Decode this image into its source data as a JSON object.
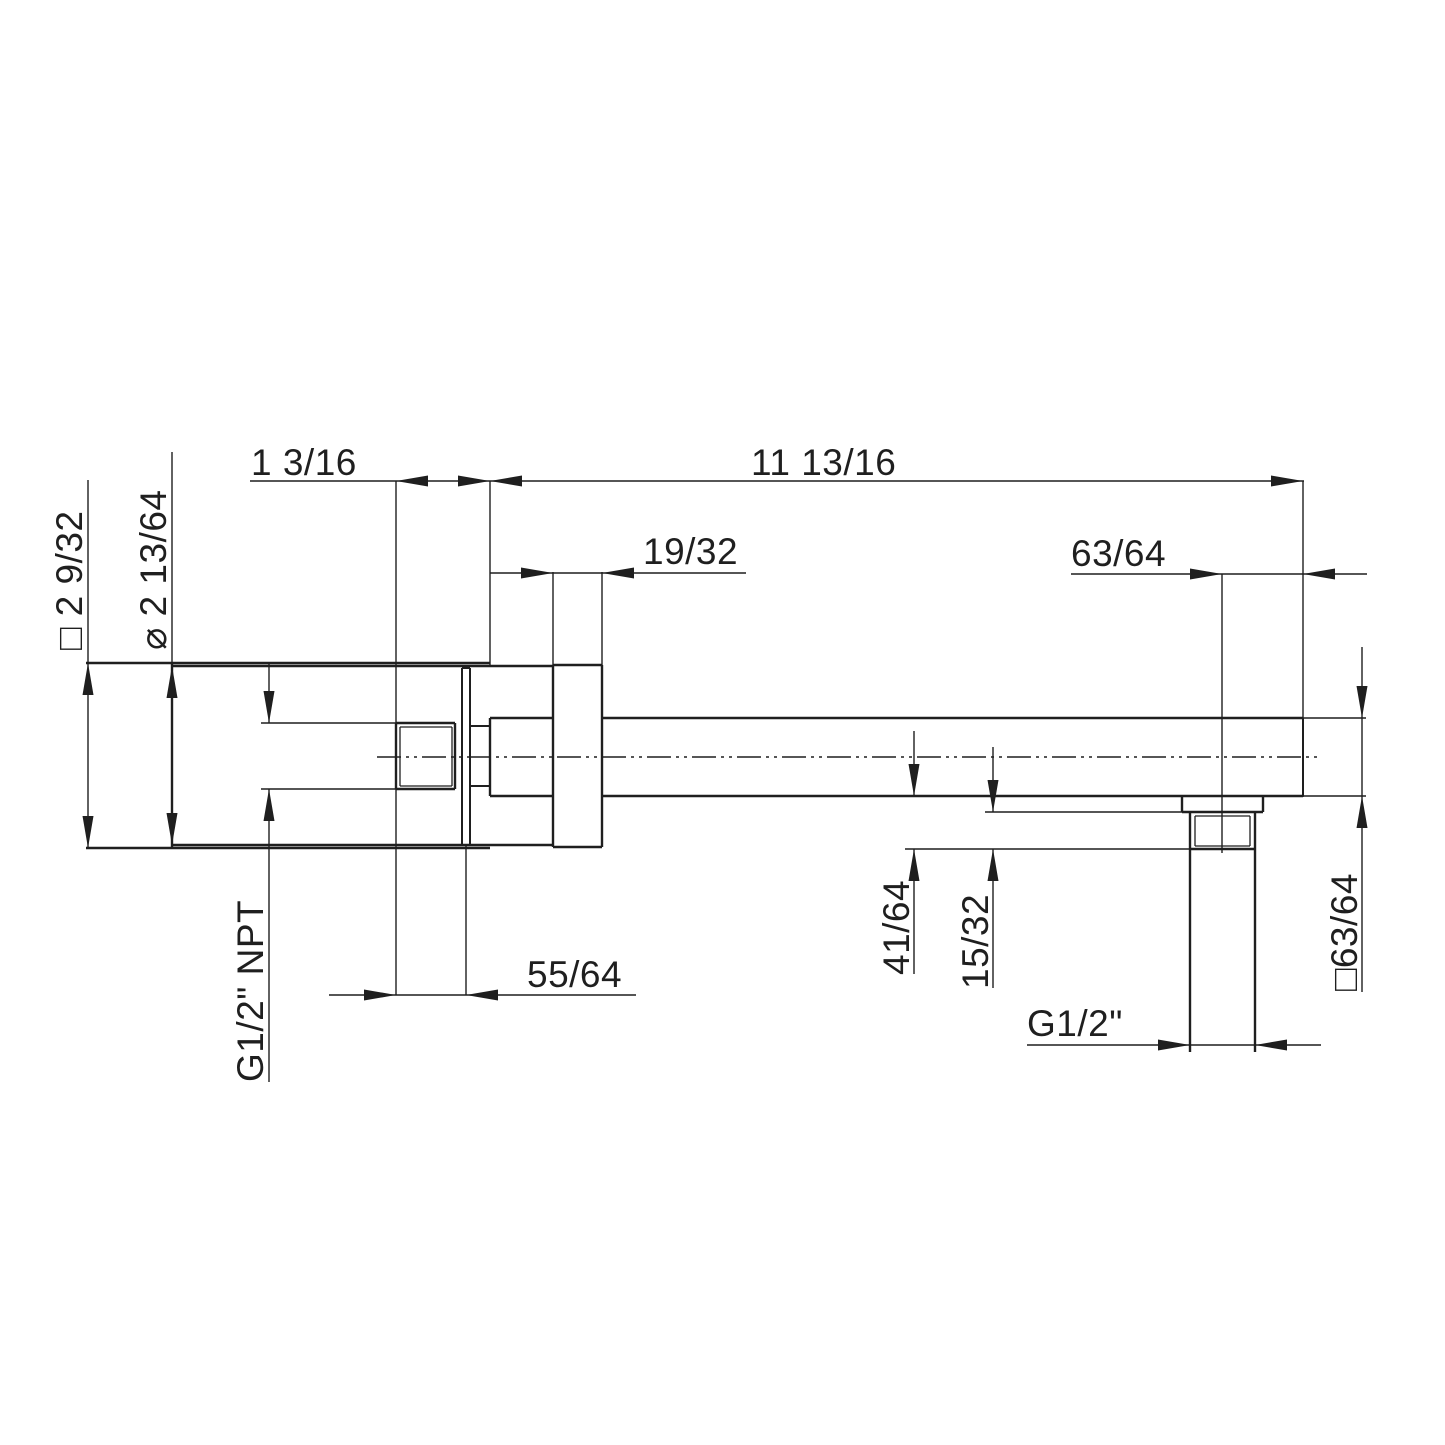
{
  "meta": {
    "background": "#ffffff",
    "line_color": "#1f1f1f",
    "drawing_type": "dimension-drawing"
  },
  "labels": {
    "protrusion": "1 3/16",
    "arm_length": "11 13/16",
    "slide_escutcheon_thickness": "19/32",
    "outlet_to_end": "63/64",
    "wall_escutcheon_square": "□ 2 9/32",
    "wall_escutcheon_diameter": "⌀ 2 13/64",
    "inlet_thread": "G1/2\" NPT",
    "inlet_thread_length": "55/64",
    "drop_depth": "41/64",
    "outlet_thread_length": "15/32",
    "outlet_thread": "G1/2\"",
    "arm_square_profile": "□63/64"
  }
}
